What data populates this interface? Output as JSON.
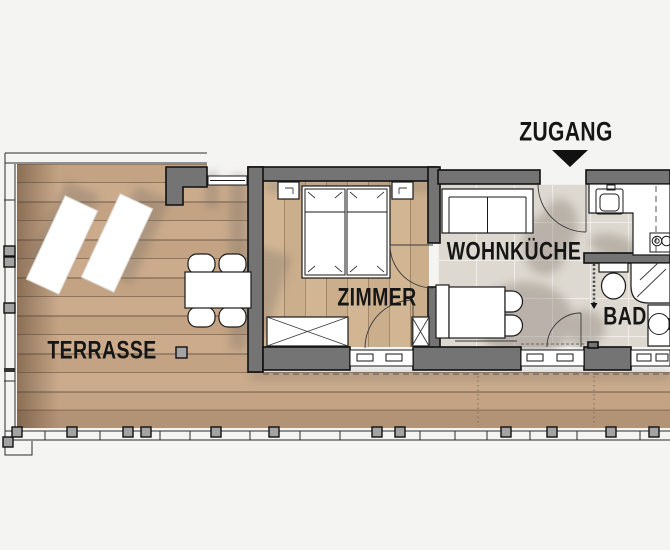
{
  "labels": {
    "entrance": "ZUGANG",
    "living_kitchen": "WOHNKÜCHE",
    "bedroom": "ZIMMER",
    "bathroom": "BAD",
    "terrace": "TERRASSE"
  },
  "entrance_marker": {
    "icon": "triangle-down"
  },
  "colors": {
    "background": "#f4f4f3",
    "wall": "#757474",
    "outline": "#101010",
    "deck_wood_a": "#cbab8c",
    "deck_wood_b": "#c3a383",
    "deck_line": "#6e5b49",
    "room_wood_a": "#d2b694",
    "room_wood_b": "#cbae8c",
    "tile": "#ddd8d0",
    "fixture": "#ffffff",
    "shadow": "#7d7268",
    "label": "#161616",
    "post": "#a3a3a3"
  }
}
